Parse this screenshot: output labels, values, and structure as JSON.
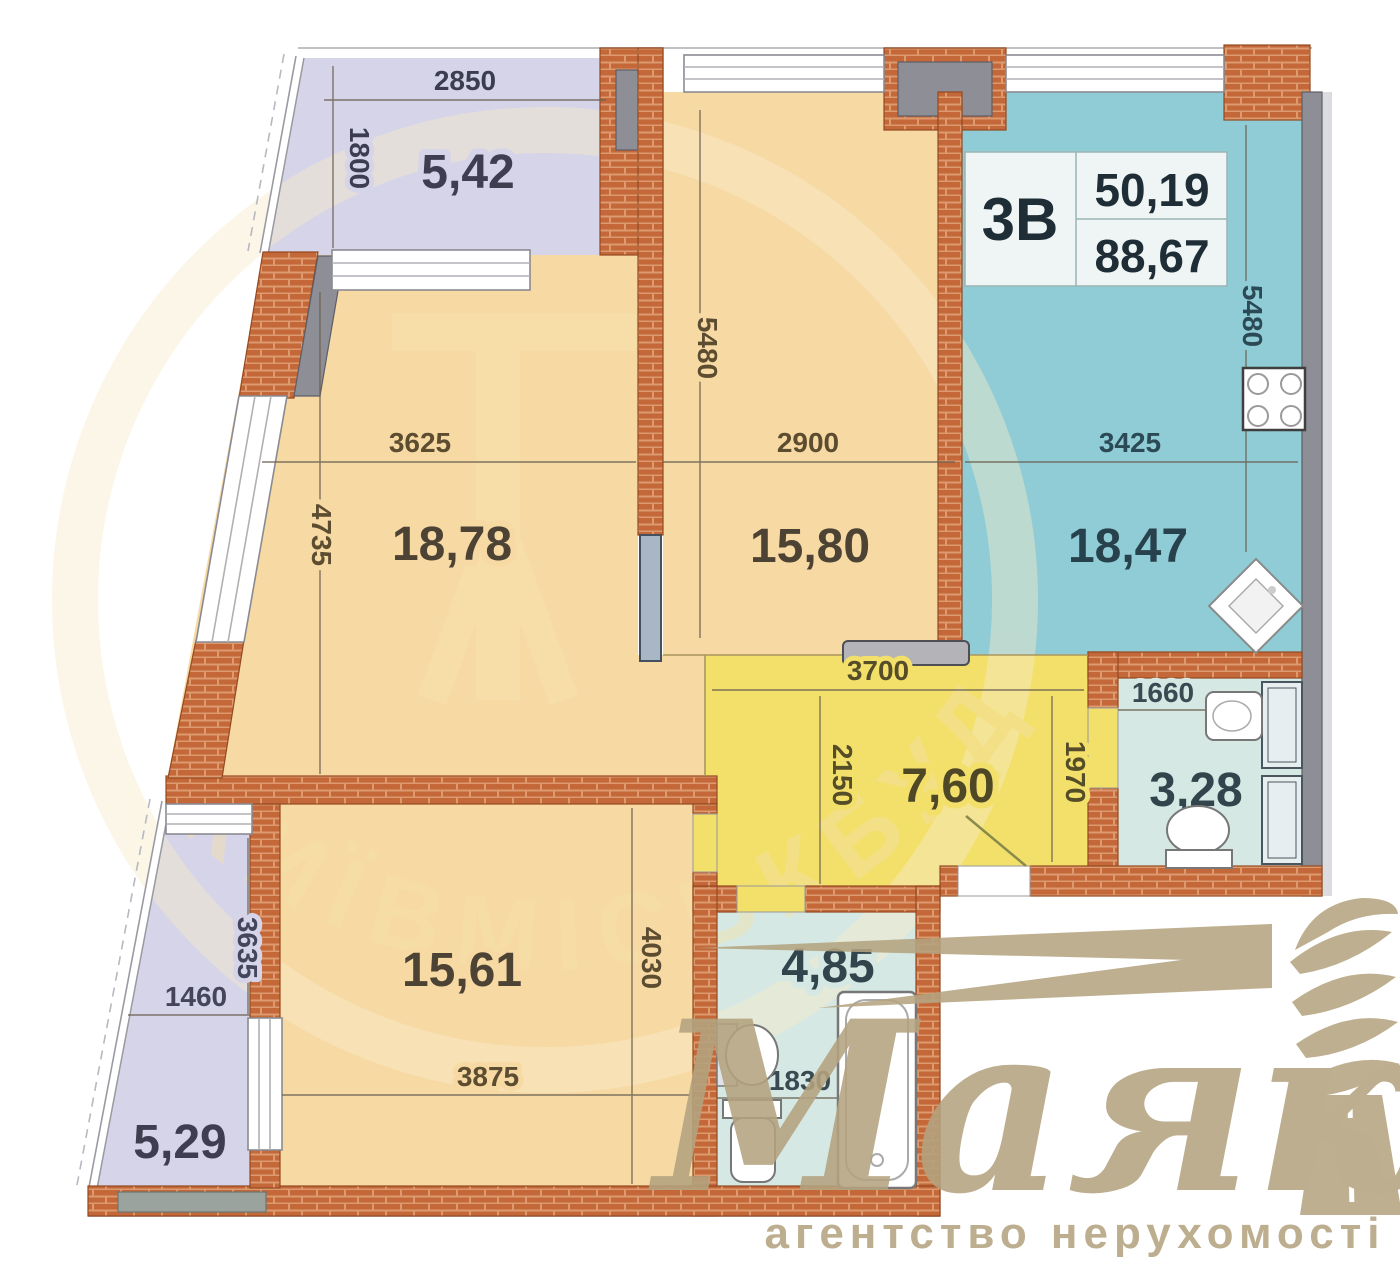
{
  "info_box": {
    "unit": "3В",
    "area_living": "50,19",
    "area_total": "88,67"
  },
  "rooms": {
    "balcony_top": {
      "area": "5,42",
      "dim_w": "2850",
      "dim_h": "1800"
    },
    "living": {
      "area": "18,78",
      "dim_w": "3625",
      "dim_h": "4735"
    },
    "bedroom_mid": {
      "area": "15,80",
      "dim_w": "2900",
      "dim_h": "5480"
    },
    "kitchen": {
      "area": "18,47",
      "dim_w": "3425",
      "dim_h": "5480"
    },
    "hall": {
      "area": "7,60",
      "dim_w": "3700",
      "dim_h_left": "2150",
      "dim_h_right": "1970"
    },
    "wc": {
      "area": "3,28",
      "dim_w": "1660"
    },
    "bedroom_low": {
      "area": "15,61",
      "dim_w": "3875",
      "dim_h": "4030"
    },
    "balcony_low": {
      "area": "5,29",
      "dim_w": "1460",
      "dim_h": "3635"
    },
    "bath": {
      "area": "4,85",
      "dim_w": "1830"
    }
  },
  "brand": {
    "name": "Маяк",
    "tagline": "агентство нерухомості"
  },
  "stamp": {
    "text": "КИЇВМІСЬКБУД"
  },
  "colors": {
    "brick": "#c4683a",
    "room_orange": "#f7d9a4",
    "balcony_lavender": "#d6d4e8",
    "kitchen_teal": "#8fccd5",
    "bath_teal": "#d5e8e4",
    "hall_yellow": "#f2e06b",
    "wall_gray": "#8e8e96",
    "brand_gold": "#b4a480"
  }
}
